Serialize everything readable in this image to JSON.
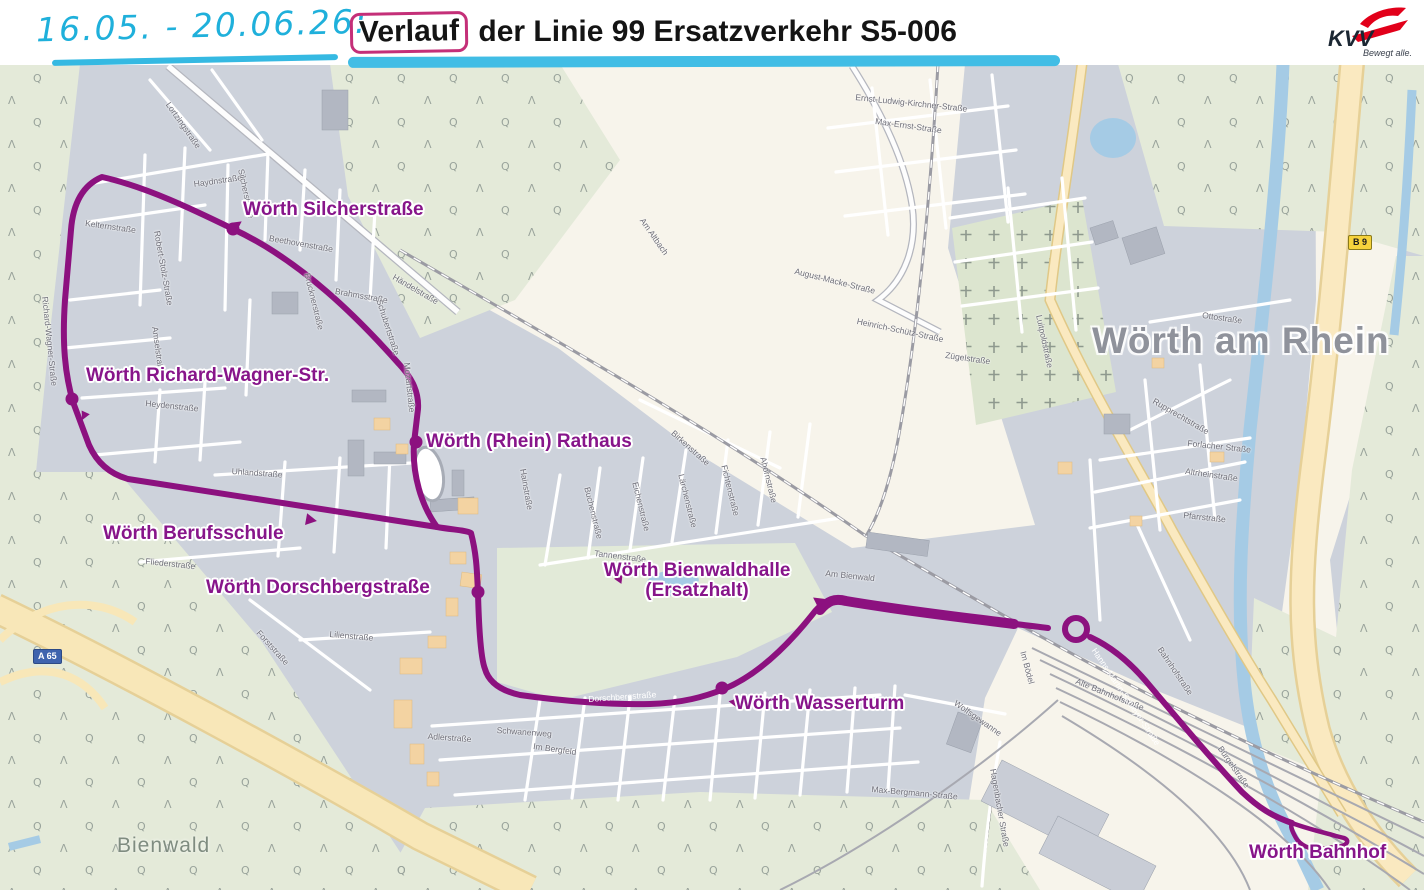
{
  "header": {
    "handwritten_dates": "16.05. - 20.06.26:",
    "title_boxed_word": "Verlauf",
    "title_rest": " der Linie 99 Ersatzverkehr S5-006"
  },
  "logo": {
    "name": "KVV",
    "tagline": "Bewegt alle."
  },
  "map": {
    "town_label": "Wörth am Rhein",
    "forest_label": "Bienwald",
    "colors": {
      "route_purple": "#8C117F",
      "stop_label_purple": "#87158A",
      "handwriting_cyan": "#1FB0DB",
      "highlight_pink": "#C42F78",
      "underline_cyan": "#41BDE5",
      "logo_red": "#E2001A",
      "residential_gray": "#CDD2DB",
      "open_cream": "#F7F4EB",
      "forest_green": "#E4EAD9",
      "water_blue": "#A5CBE5",
      "road_yellow": "#F8E7B8"
    },
    "badges": [
      {
        "id": "a65",
        "label": "A 65",
        "x": 33,
        "y": 649,
        "style": "motorway"
      },
      {
        "id": "b9",
        "label": "B 9",
        "x": 1348,
        "y": 235,
        "style": "bundesstrasse"
      }
    ],
    "stops": [
      {
        "id": "silcherstrasse",
        "name": "Wörth Silcherstraße",
        "marker": "dot",
        "mx": 233,
        "my": 229,
        "lx": 243,
        "ly": 200,
        "align": "left"
      },
      {
        "id": "richard-wagner",
        "name": "Wörth Richard-Wagner-Str.",
        "marker": "dot",
        "mx": 72,
        "my": 399,
        "lx": 86,
        "ly": 366,
        "align": "left"
      },
      {
        "id": "rathaus",
        "name": "Wörth (Rhein) Rathaus",
        "marker": "dot",
        "mx": 416,
        "my": 442,
        "lx": 426,
        "ly": 432,
        "align": "left"
      },
      {
        "id": "berufsschule",
        "name": "Wörth Berufsschule",
        "marker": "arrow",
        "mx": 311,
        "my": 520,
        "rot": 100,
        "lx": 103,
        "ly": 524,
        "align": "left"
      },
      {
        "id": "dorschbergstrasse",
        "name": "Wörth Dorschbergstraße",
        "marker": "dot",
        "mx": 478,
        "my": 592,
        "lx": 206,
        "ly": 578,
        "align": "left"
      },
      {
        "id": "bienwaldhalle",
        "name": "Wörth Bienwaldhalle",
        "name2": "(Ersatzhalt)",
        "marker": "arrow",
        "mx": 818,
        "my": 601,
        "rot": -55,
        "lx": 697,
        "ly": 561,
        "align": "center"
      },
      {
        "id": "wasserturm",
        "name": "Wörth Wasserturm",
        "marker": "dot",
        "mx": 722,
        "my": 688,
        "lx": 735,
        "ly": 694,
        "align": "left"
      },
      {
        "id": "bahnhof",
        "name": "Wörth Bahnhof",
        "marker": "loop",
        "mx": 1318,
        "my": 832,
        "lx": 1249,
        "ly": 843,
        "align": "left"
      }
    ],
    "route_arrows": [
      {
        "x": 238,
        "y": 224,
        "rot": 55
      },
      {
        "x": 84,
        "y": 416,
        "rot": 205
      },
      {
        "x": 733,
        "y": 702,
        "rot": -80
      },
      {
        "x": 620,
        "y": 578,
        "rot": 35
      }
    ],
    "street_labels": [
      {
        "t": "Lortzingstraße",
        "x": 172,
        "y": 100,
        "r": 55
      },
      {
        "t": "Haydnstraße",
        "x": 193,
        "y": 179,
        "r": -8
      },
      {
        "t": "Silcherstraße",
        "x": 246,
        "y": 168,
        "r": 78
      },
      {
        "t": "Beethovenstraße",
        "x": 270,
        "y": 233,
        "r": 10
      },
      {
        "t": "Brucknerstraße",
        "x": 312,
        "y": 272,
        "r": 76
      },
      {
        "t": "Brahmsstraße",
        "x": 336,
        "y": 286,
        "r": 10
      },
      {
        "t": "Schubertstraße",
        "x": 384,
        "y": 298,
        "r": 72
      },
      {
        "t": "Händelstraße",
        "x": 396,
        "y": 272,
        "r": 30
      },
      {
        "t": "Robert-Stolz-Straße",
        "x": 162,
        "y": 230,
        "r": 80
      },
      {
        "t": "Kelternstraße",
        "x": 86,
        "y": 218,
        "r": 8
      },
      {
        "t": "Amselstraße",
        "x": 160,
        "y": 326,
        "r": 82
      },
      {
        "t": "Richard-Wagner-Straße",
        "x": 50,
        "y": 296,
        "r": 84
      },
      {
        "t": "Heydenstraße",
        "x": 146,
        "y": 398,
        "r": 6
      },
      {
        "t": "Uhlandstraße",
        "x": 232,
        "y": 466,
        "r": 4
      },
      {
        "t": "Fliederstraße",
        "x": 146,
        "y": 556,
        "r": 6
      },
      {
        "t": "Forststraße",
        "x": 262,
        "y": 628,
        "r": 48
      },
      {
        "t": "Lilienstraße",
        "x": 330,
        "y": 629,
        "r": 5
      },
      {
        "t": "Mozartstraße",
        "x": 412,
        "y": 362,
        "r": 84,
        "c": "#6E6E78"
      },
      {
        "t": "Dorschbergstraße",
        "x": 588,
        "y": 694,
        "r": -4,
        "c": "#ffffff"
      },
      {
        "t": "Hainstraße",
        "x": 528,
        "y": 468,
        "r": 80
      },
      {
        "t": "Buchenstraße",
        "x": 592,
        "y": 486,
        "r": 76
      },
      {
        "t": "Tannenstraße",
        "x": 595,
        "y": 548,
        "r": 7
      },
      {
        "t": "Eichenstraße",
        "x": 640,
        "y": 481,
        "r": 76
      },
      {
        "t": "Lärchenstraße",
        "x": 686,
        "y": 473,
        "r": 76
      },
      {
        "t": "Fichtenstraße",
        "x": 729,
        "y": 464,
        "r": 76
      },
      {
        "t": "Ahornstraße",
        "x": 768,
        "y": 456,
        "r": 76
      },
      {
        "t": "Birkenstraße",
        "x": 676,
        "y": 428,
        "r": 42
      },
      {
        "t": "Am Bienwald",
        "x": 826,
        "y": 568,
        "r": 6
      },
      {
        "t": "Am Altbach",
        "x": 646,
        "y": 216,
        "r": 55
      },
      {
        "t": "Adlerstraße",
        "x": 428,
        "y": 731,
        "r": 4
      },
      {
        "t": "Schwanenweg",
        "x": 497,
        "y": 725,
        "r": 4
      },
      {
        "t": "Im Bergfeld",
        "x": 534,
        "y": 741,
        "r": 8
      },
      {
        "t": "Max-Bergmann-Straße",
        "x": 872,
        "y": 784,
        "r": 5
      },
      {
        "t": "Hagenbacher Straße",
        "x": 998,
        "y": 768,
        "r": 80
      },
      {
        "t": "Wolfsgewanne",
        "x": 958,
        "y": 698,
        "r": 35
      },
      {
        "t": "August-Macke-Straße",
        "x": 796,
        "y": 266,
        "r": 14
      },
      {
        "t": "Heinrich-Schütz-Straße",
        "x": 858,
        "y": 316,
        "r": 12
      },
      {
        "t": "Zügelstraße",
        "x": 946,
        "y": 350,
        "r": 8
      },
      {
        "t": "Max-Ernst-Straße",
        "x": 876,
        "y": 116,
        "r": 8
      },
      {
        "t": "Ernst-Ludwig-Kirchner-Straße",
        "x": 856,
        "y": 92,
        "r": 6
      },
      {
        "t": "Luitpoldstraße",
        "x": 1044,
        "y": 314,
        "r": 78
      },
      {
        "t": "Ottostraße",
        "x": 1203,
        "y": 310,
        "r": 8
      },
      {
        "t": "Rupprechtstraße",
        "x": 1156,
        "y": 396,
        "r": 30
      },
      {
        "t": "Forlacher Straße",
        "x": 1188,
        "y": 438,
        "r": 6
      },
      {
        "t": "Altrheinstraße",
        "x": 1186,
        "y": 466,
        "r": 8
      },
      {
        "t": "Pfarrstraße",
        "x": 1184,
        "y": 510,
        "r": 6
      },
      {
        "t": "Im Bödel",
        "x": 1028,
        "y": 650,
        "r": 75
      },
      {
        "t": "Bahnhofstraße",
        "x": 1164,
        "y": 645,
        "r": 56
      },
      {
        "t": "Alte Bahnhofstraße",
        "x": 1078,
        "y": 676,
        "r": 22
      },
      {
        "t": "Hanns-Martin-Schleyer-Straße",
        "x": 1098,
        "y": 646,
        "r": 56,
        "c": "#ffffff"
      },
      {
        "t": "Bürgelstraße",
        "x": 1224,
        "y": 744,
        "r": 55
      }
    ]
  }
}
